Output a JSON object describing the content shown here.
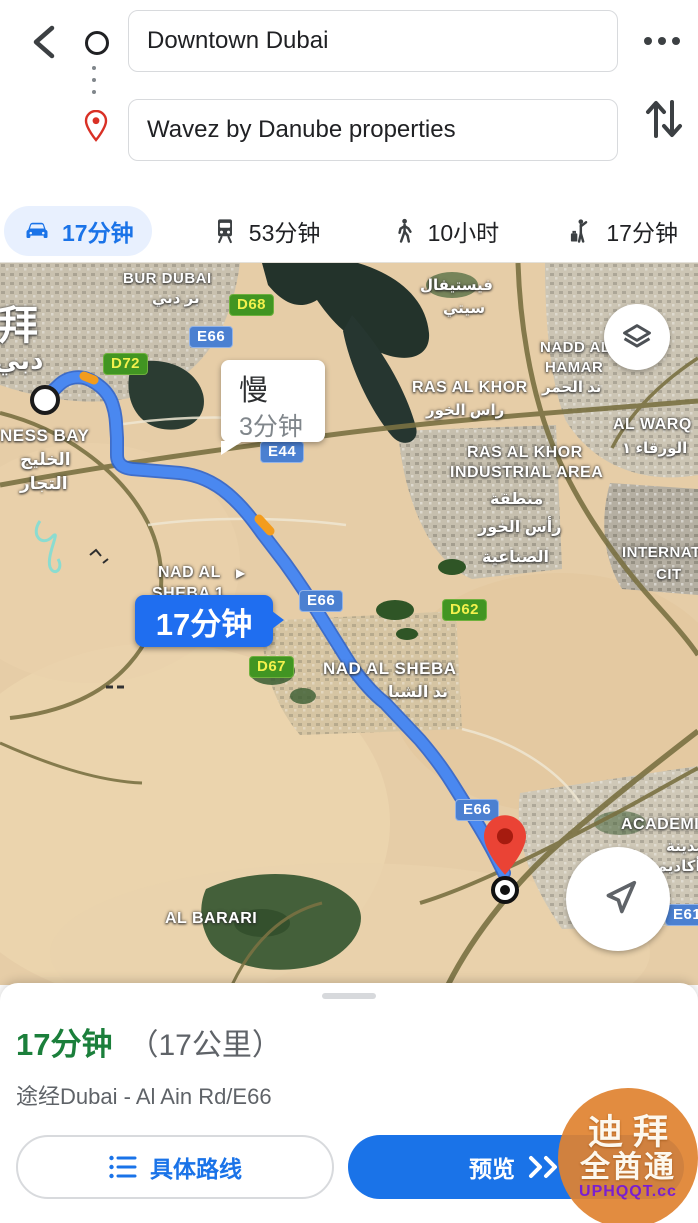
{
  "header": {
    "origin_value": "Downtown Dubai",
    "destination_value": "Wavez by Danube properties"
  },
  "tabs": [
    {
      "mode": "drive",
      "label": "17分钟",
      "selected": true
    },
    {
      "mode": "transit",
      "label": "53分钟",
      "selected": false
    },
    {
      "mode": "walk",
      "label": "10小时",
      "selected": false
    },
    {
      "mode": "ride",
      "label": "17分钟",
      "selected": false
    }
  ],
  "map": {
    "traffic_callout": {
      "title": "慢",
      "time": "3分钟"
    },
    "route_callout": {
      "time": "17分钟"
    },
    "badges": {
      "d68": "D68",
      "e66_top": "E66",
      "d72": "D72",
      "e44": "E44",
      "e66_mid": "E66",
      "d67": "D67",
      "d62": "D62",
      "e66_low": "E66",
      "e611": "E611"
    },
    "labels": {
      "bur_dubai": "BUR DUBAI",
      "bur_dubai_ar": "بر دبي",
      "dubai_zh": "拜",
      "dubai_ar": "دبي",
      "business_bay": "NESS BAY",
      "business_bay_ar1": "الخليج",
      "business_bay_ar2": "التجار",
      "festival_city_ar1": "فيستيفال",
      "festival_city_ar2": "سيتي",
      "ras_al_khor": "RAS AL KHOR",
      "ras_al_khor_ar": "راس الخور",
      "nadd_al_hamar1": "NADD AL",
      "nadd_al_hamar2": "HAMAR",
      "nadd_al_hamar_ar": "ند الحمر",
      "al_warqa": "AL WARQ",
      "al_warqa_ar": "الورقاء ١",
      "rak_industrial1": "RAS AL KHOR",
      "rak_industrial2": "INDUSTRIAL AREA",
      "rak_industrial_ar1": "منطقة",
      "rak_industrial_ar2": "رأس الخور",
      "rak_industrial_ar3": "الصناعية",
      "international1": "INTERNAT",
      "international2": "CIT",
      "nad_al_sheba1_l1": "NAD AL",
      "nad_al_sheba1_l2": "SHEBA 1",
      "nad_al_sheba1_arrow": "▶",
      "nad_al_sheba": "NAD AL SHEBA",
      "nad_al_sheba_ar": "ند الشبا",
      "al_barari": "AL BARARI",
      "academic": "ACADEMI",
      "academic_ar1": "مدينة",
      "academic_ar2": "أكاديم"
    }
  },
  "panel": {
    "duration": "17分钟",
    "distance": "（17公里）",
    "via": "途经Dubai - Al Ain Rd/E66",
    "details_label": "具体路线",
    "preview_label": "预览"
  },
  "watermark": {
    "line1": "迪拜",
    "line2": "全酋通",
    "line3": "UPHQQT.cc"
  },
  "colors": {
    "accent_blue": "#1a73e8",
    "route_blue": "#4a88f0",
    "duration_green": "#1b7f3b",
    "badge_green_bg": "#419522",
    "badge_green_text": "#f3f14d",
    "badge_blue_bg": "#4b80d1",
    "traffic_orange": "#f39c1d"
  }
}
